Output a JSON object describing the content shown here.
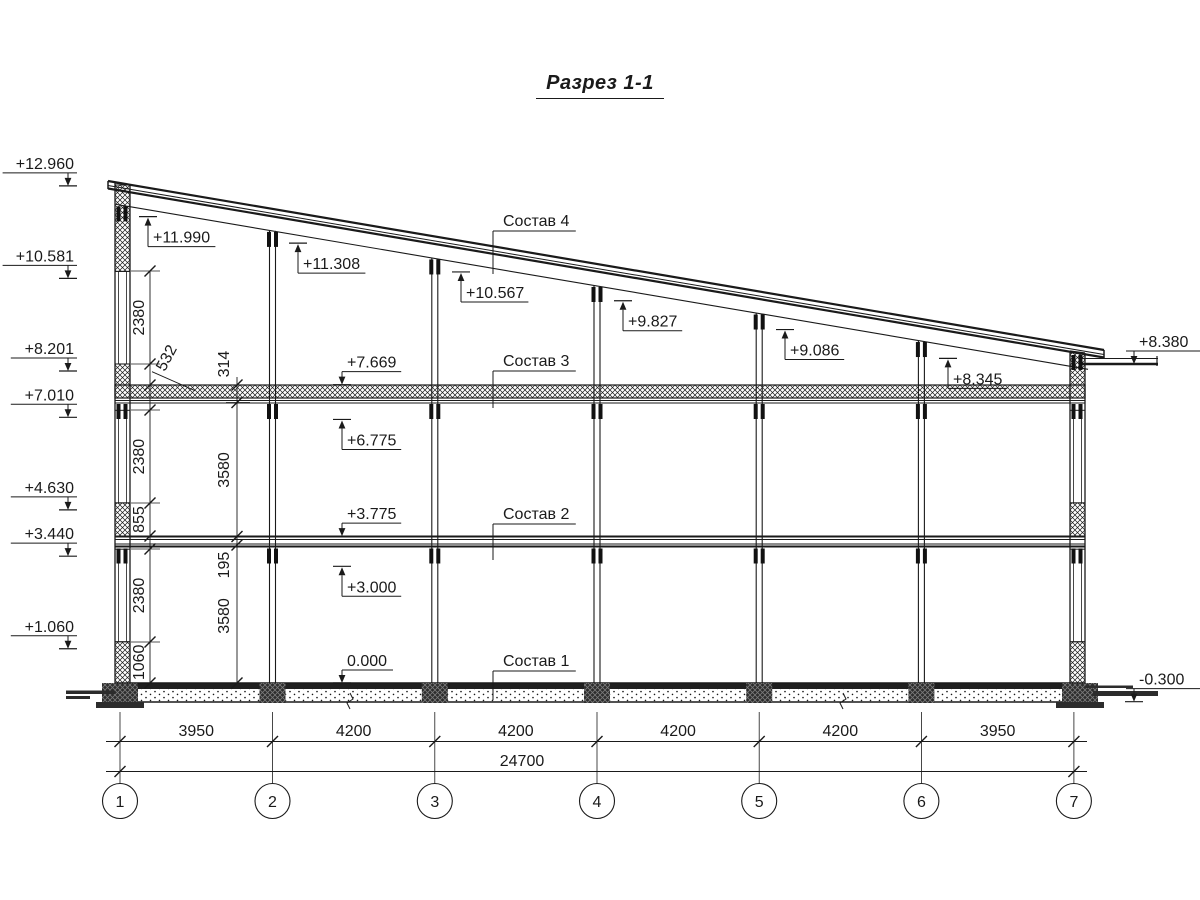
{
  "title": "Разрез 1-1",
  "colors": {
    "ink": "#1a1a1a",
    "paper": "#ffffff"
  },
  "elevation_marks": {
    "left": [
      {
        "label": "+12.960",
        "mm": 12960
      },
      {
        "label": "+10.581",
        "mm": 10581
      },
      {
        "label": "+8.201",
        "mm": 8201
      },
      {
        "label": "+7.010",
        "mm": 7010
      },
      {
        "label": "+4.630",
        "mm": 4630
      },
      {
        "label": "+3.440",
        "mm": 3440
      },
      {
        "label": "+1.060",
        "mm": 1060
      }
    ],
    "right": [
      {
        "label": "+8.380",
        "mm": 8380
      },
      {
        "label": "-0.300",
        "mm": -300
      }
    ],
    "interior_up": [
      {
        "label": "+11.990",
        "mm": 11990,
        "x": 148
      },
      {
        "label": "+11.308",
        "mm": 11308,
        "x": 298
      },
      {
        "label": "+10.567",
        "mm": 10567,
        "x": 461
      },
      {
        "label": "+9.827",
        "mm": 9827,
        "x": 623
      },
      {
        "label": "+9.086",
        "mm": 9086,
        "x": 785
      },
      {
        "label": "+8.345",
        "mm": 8345,
        "x": 948
      },
      {
        "label": "+6.775",
        "mm": 6775,
        "x": 342
      },
      {
        "label": "+3.000",
        "mm": 3000,
        "x": 342
      }
    ],
    "interior_down": [
      {
        "label": "+7.669",
        "mm": 7669,
        "x": 342
      },
      {
        "label": "+3.775",
        "mm": 3775,
        "x": 342
      },
      {
        "label": "0.000",
        "mm": 0,
        "x": 342
      }
    ]
  },
  "compositions": [
    {
      "label": "Состав 4",
      "x": 493,
      "text_y": 226,
      "leader_bottom": 274
    },
    {
      "label": "Состав 3",
      "x": 493,
      "text_y": 366,
      "leader_bottom": 408
    },
    {
      "label": "Состав 2",
      "x": 493,
      "text_y": 519,
      "leader_bottom": 560
    },
    {
      "label": "Состав 1",
      "x": 493,
      "text_y": 666,
      "leader_bottom": 700
    }
  ],
  "vertical_dims": {
    "chain_near_wall": {
      "x": 150,
      "segments": [
        {
          "label": "2380",
          "top_mm": 10581,
          "bot_mm": 8201
        },
        {
          "label": "532",
          "top_mm": 8201,
          "bot_mm": 7669,
          "diagonal": true
        },
        {
          "label": "2380",
          "top_mm": 7010,
          "bot_mm": 4630
        },
        {
          "label": "855",
          "top_mm": 4630,
          "bot_mm": 3775
        },
        {
          "label": "2380",
          "top_mm": 3440,
          "bot_mm": 1060
        },
        {
          "label": "1060",
          "top_mm": 1060,
          "bot_mm": 0
        }
      ]
    },
    "chain_inner": {
      "x": 237,
      "segments": [
        {
          "label": "314",
          "top_y": 385,
          "bot_y": 402.5,
          "label_y": 364
        },
        {
          "label": "3580",
          "top_y": 402.5,
          "bot_y": 536.5,
          "label_y": 470
        },
        {
          "label": "195",
          "top_y": 536.5,
          "bot_y": 545,
          "label_y": 565
        },
        {
          "label": "3580",
          "top_y": 545,
          "bot_y": 683,
          "label_y": 616
        }
      ]
    }
  },
  "horizontal_dims": {
    "spans": [
      "3950",
      "4200",
      "4200",
      "4200",
      "4200",
      "3950"
    ],
    "total": "24700"
  },
  "axes": [
    "1",
    "2",
    "3",
    "4",
    "5",
    "6",
    "7"
  ]
}
